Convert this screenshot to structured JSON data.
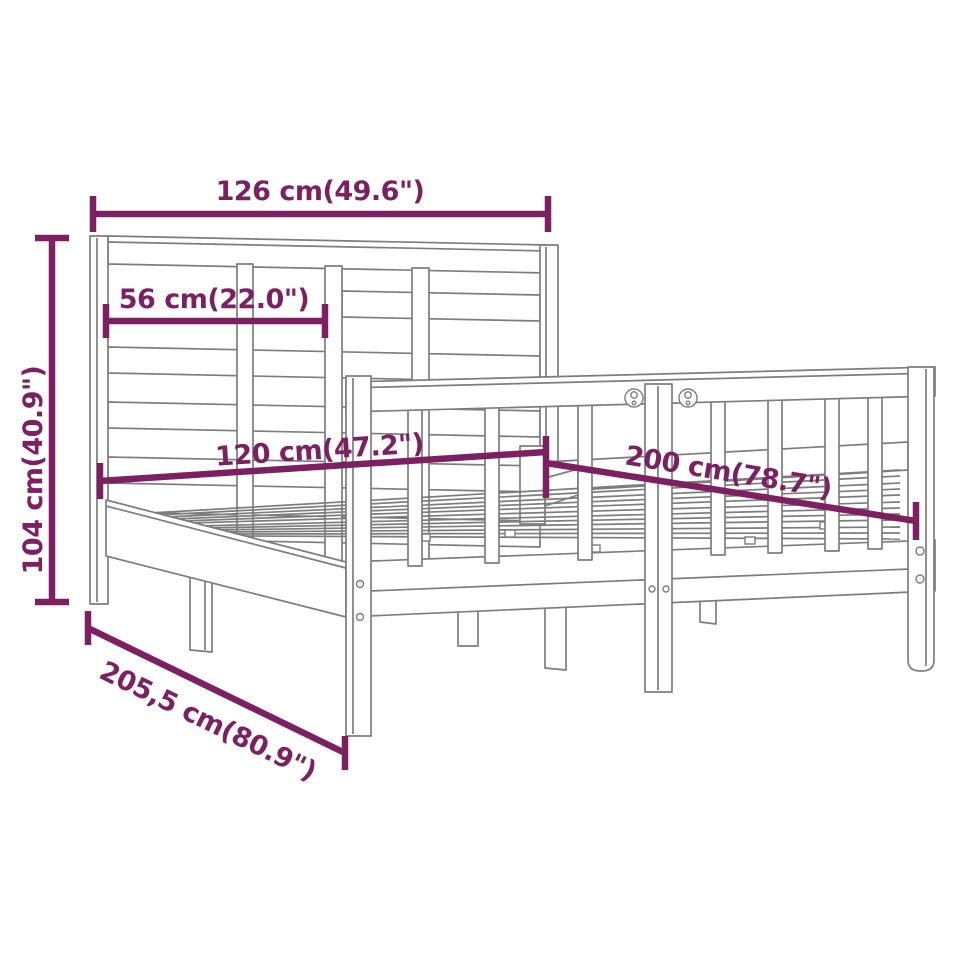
{
  "diagram": {
    "type": "product-dimension-diagram",
    "subject": "wooden bed frame with slatted headboard and spindle side rail",
    "colors": {
      "line_art": "#7d7d7d",
      "dimension": "#7c2061",
      "background": "#ffffff"
    },
    "labels": {
      "headboard_width": "126 cm(49.6\")",
      "headboard_slat_span": "56 cm(22.0\")",
      "headboard_height": "104 cm(40.9\")",
      "bed_width": "120 cm(47.2\")",
      "bed_length": "200 cm(78.7\")",
      "overall_length": "205,5 cm(80.9\")"
    }
  }
}
